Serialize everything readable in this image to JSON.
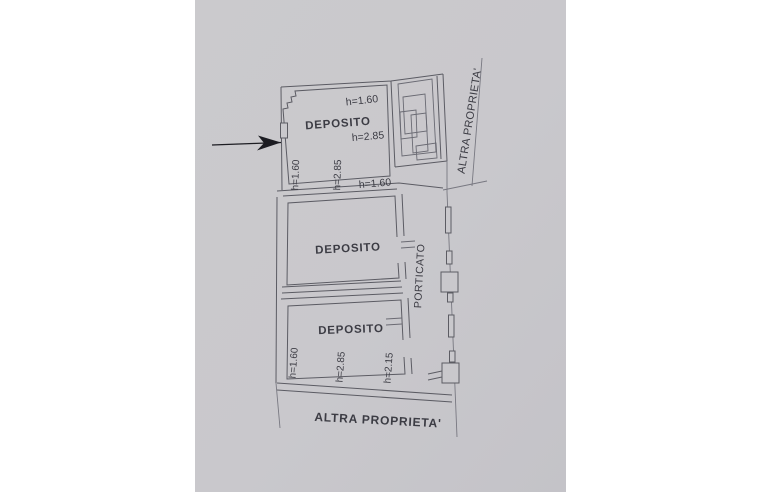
{
  "colors": {
    "paper": "#c9c8cc",
    "wall_ink": "#5b5b64",
    "text_ink": "#3c3c44",
    "arrow_ink": "#1e1e24"
  },
  "plan": {
    "rooms": [
      {
        "name": "DEPOSITO",
        "position": "top",
        "heights": {
          "top": "h=1.60",
          "middle": "h=2.85",
          "left": "h=1.60",
          "left_inner": "h=2.85",
          "bottom": "h=1.60"
        }
      },
      {
        "name": "DEPOSITO",
        "position": "middle"
      },
      {
        "name": "DEPOSITO",
        "position": "bottom",
        "heights": {
          "left": "h=1.60",
          "middle": "h=2.85",
          "right": "h=2.15"
        }
      }
    ],
    "porticato_label": "PORTICATO",
    "boundary_right": "ALTRA PROPRIETA'",
    "boundary_bottom": "ALTRA PROPRIETA'"
  }
}
